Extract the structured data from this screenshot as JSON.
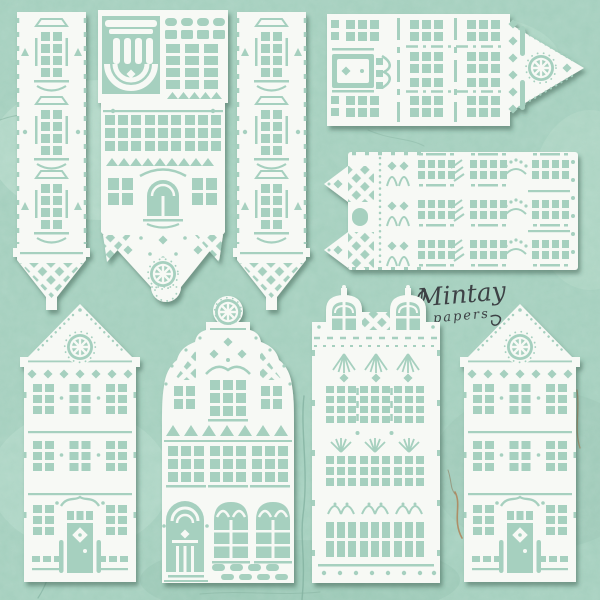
{
  "scene": {
    "product": "Laser-cut white chipboard houses craft set on cracked mint painted background",
    "background_color": "#a7d1c0",
    "chipboard_color": "#f7f9f5",
    "cutout_color": "#a6d0bf",
    "shadow_color": "#2e5040",
    "crack_color": "#7fae9c",
    "rust_crack_color": "#b0784a"
  },
  "logo": {
    "brand": "Mintay",
    "sub": "papers",
    "color": "#3d4145"
  },
  "pieces": [
    {
      "name": "tower-strip-left",
      "desc": "narrow tower strip, three 2x4-pane windows, lattice point"
    },
    {
      "name": "tower-wide-center",
      "desc": "wide tower, column-and-arch capital, window grids, lattice taper with spoke wheel and stitched tab"
    },
    {
      "name": "tower-strip-right",
      "desc": "narrow tower strip, three 2x4-pane windows, lattice point"
    },
    {
      "name": "house-sideways-right-gable",
      "desc": "sideways house, pointed gable with spoke-wheel window, door and window bands"
    },
    {
      "name": "house-sideways-twin-spires",
      "desc": "sideways house, twin lattice spires, lace columns, window rows"
    },
    {
      "name": "house-triangle-gable-left",
      "desc": "tall canal house, triangle gable, wheel window, panelled door"
    },
    {
      "name": "house-bell-gable",
      "desc": "canal house, bell gable with wheel finial, arched door, gothic windows, scalloped base"
    },
    {
      "name": "house-twin-dormers",
      "desc": "tall house, two arched dormers, lace chandelier rows, three window storeys"
    },
    {
      "name": "house-triangle-gable-right",
      "desc": "tall canal house, triangle gable, wheel window, panelled door"
    }
  ]
}
